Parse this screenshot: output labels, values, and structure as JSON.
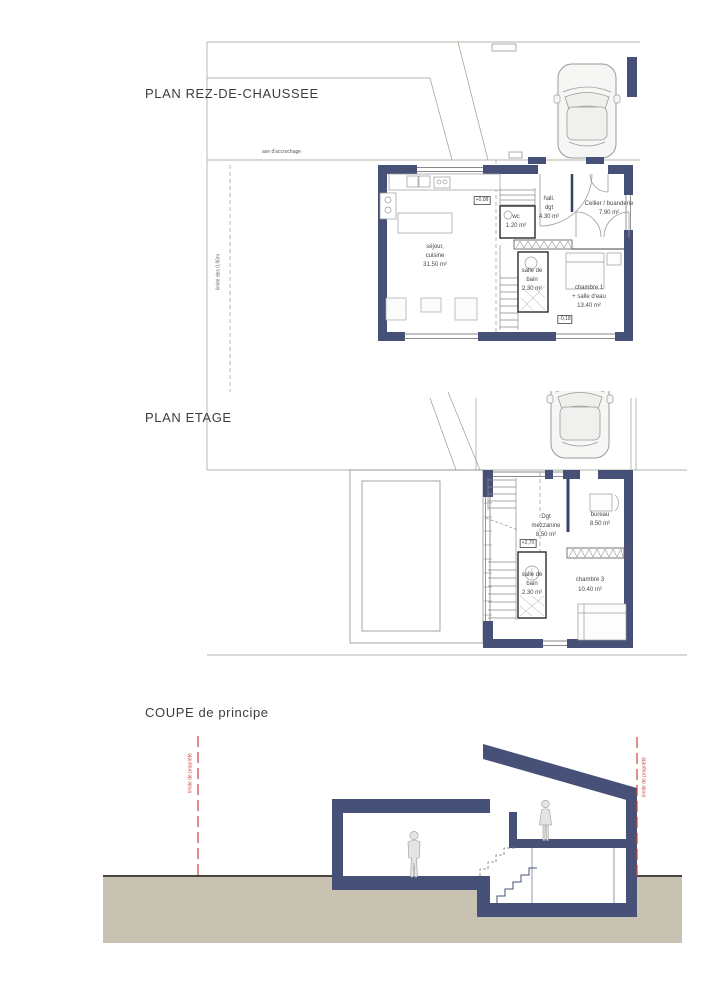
{
  "titles": {
    "rez": "PLAN REZ-DE-CHAUSSEE",
    "etage": "PLAN ETAGE",
    "coupe": "COUPE de principe"
  },
  "annotations": {
    "axe": "axe d'accrochage",
    "limite_090": "limite des 0,90m",
    "limite_prop_left": "limite de propriété",
    "limite_prop_right": "limite de propriété"
  },
  "levels": {
    "rez_main": "+0,08",
    "rez_chambre": "-0,18",
    "etage": "+2,70"
  },
  "rooms": {
    "rez": [
      {
        "name": "sejour-cuisine",
        "lines": [
          "séjour,",
          "cuisine",
          "31.50 m²"
        ]
      },
      {
        "name": "wc",
        "lines": [
          "wc",
          "1.20 m²"
        ]
      },
      {
        "name": "hall-dgt",
        "lines": [
          "hall.",
          "dgt",
          "4.30 m²"
        ]
      },
      {
        "name": "cellier-buanderie",
        "lines": [
          "Cellier / buanderie",
          "7.90 m²"
        ]
      },
      {
        "name": "salle-de-bain",
        "lines": [
          "salle de",
          "bain",
          "2.30 m²"
        ]
      },
      {
        "name": "chambre-1",
        "lines": [
          "chambre 1",
          "+ salle d'eau",
          "13.40 m²"
        ]
      }
    ],
    "etage": [
      {
        "name": "dgt-mezzanine",
        "lines": [
          "Dgt",
          "mezzanine",
          "8.50 m²"
        ]
      },
      {
        "name": "bureau",
        "lines": [
          "bureau",
          "8.50 m²"
        ]
      },
      {
        "name": "salle-de-bain-etage",
        "lines": [
          "salle de",
          "bain",
          "2.30 m²"
        ]
      },
      {
        "name": "chambre-3",
        "lines": [
          "chambre 3",
          "10.40 m²"
        ]
      }
    ]
  },
  "icons": [
    {
      "name": "car-top-icon",
      "shape": "svg-car-outline-top-view"
    },
    {
      "name": "person-standing-icon",
      "shape": "svg-human-silhouette"
    },
    {
      "name": "person-mezzanine-icon",
      "shape": "svg-human-silhouette"
    }
  ],
  "colors": {
    "wall_navy": "#475178",
    "ground_beige": "#c8c2b3",
    "boundary_red": "#cf4439",
    "line_gray": "#8e8e8e",
    "site_line": "#9b9b8f",
    "text": "#474747"
  }
}
